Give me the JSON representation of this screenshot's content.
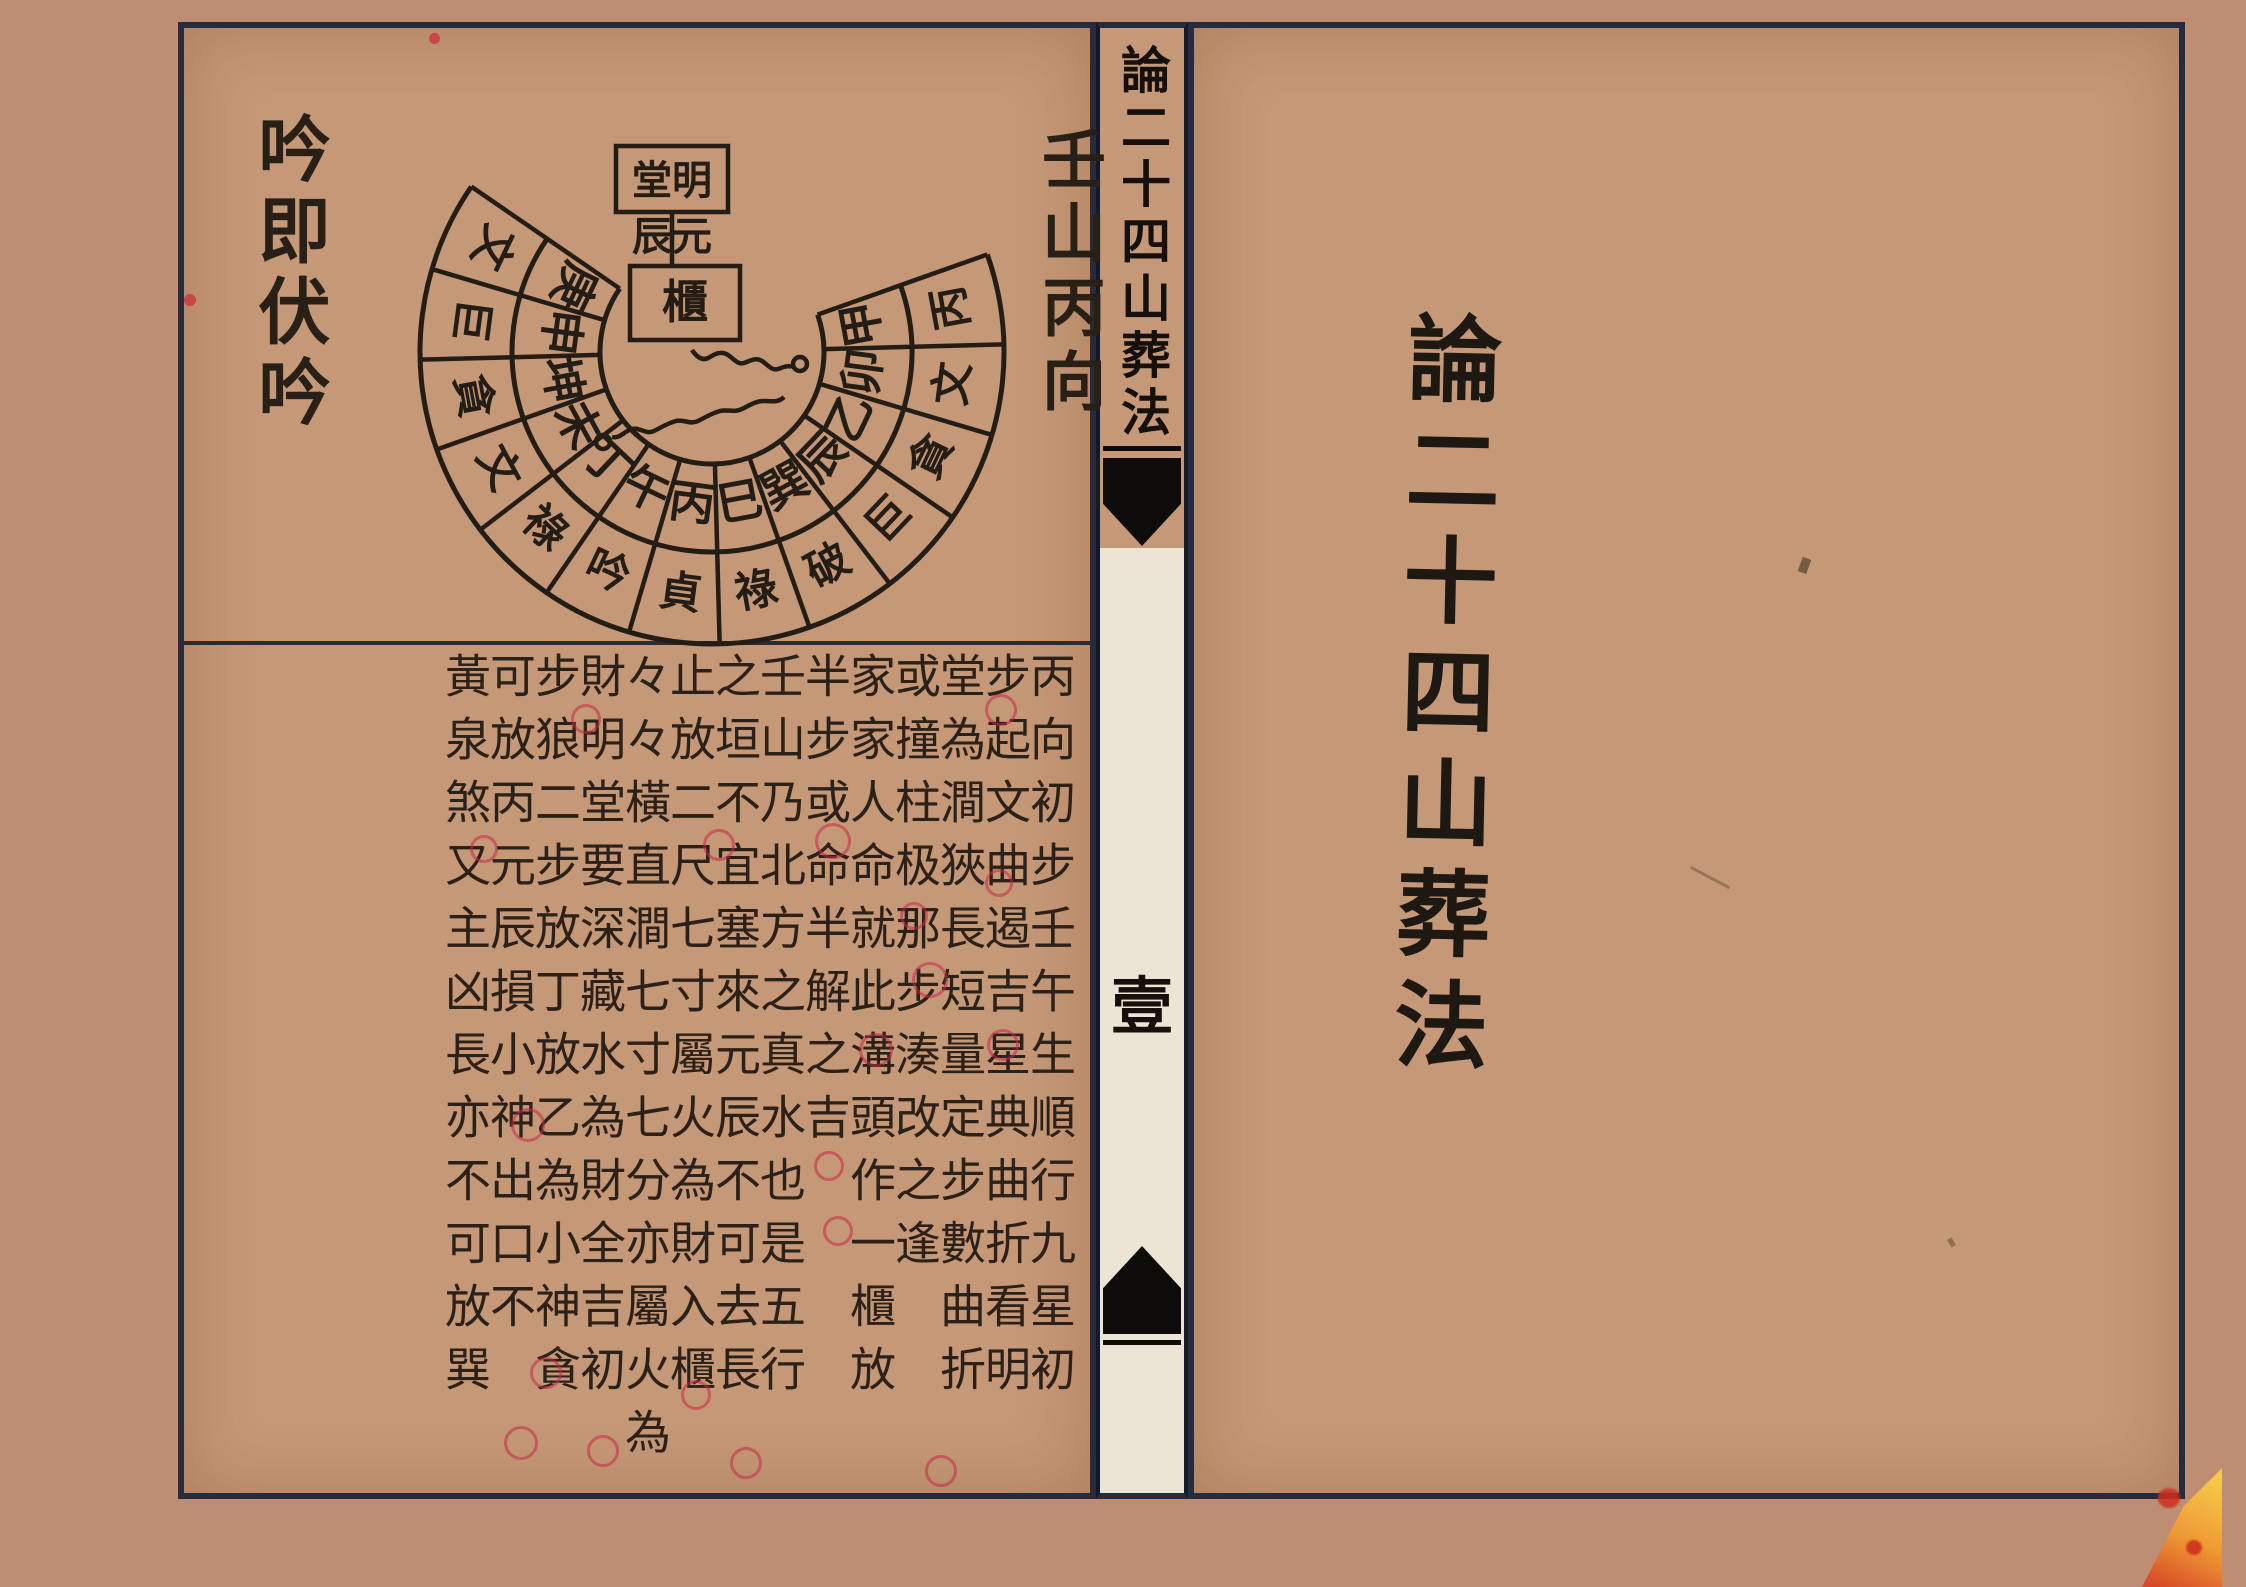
{
  "work_title": "論二十四山葬法",
  "left_page": {
    "corner_note": "吟即伏吟",
    "orientation_label": "壬山丙向",
    "diagram": {
      "center_labels": {
        "mingtang_boxed": "堂明",
        "yuanchen": "辰元",
        "cabinet_boxed": "櫃"
      },
      "cells": [
        {
          "mountain": "甲",
          "star": "丙"
        },
        {
          "mountain": "卯",
          "star": "文"
        },
        {
          "mountain": "乙",
          "star": "貪"
        },
        {
          "mountain": "辰",
          "star": "巨"
        },
        {
          "mountain": "巽",
          "star": "破"
        },
        {
          "mountain": "巳",
          "star": "祿"
        },
        {
          "mountain": "丙",
          "star": "貞"
        },
        {
          "mountain": "午",
          "star": "吟"
        },
        {
          "mountain": "丁",
          "star": "祿"
        },
        {
          "mountain": "未",
          "star": "文"
        },
        {
          "mountain": "坤",
          "star": "貪"
        },
        {
          "mountain": "申",
          "star": "巨"
        },
        {
          "mountain": "庚",
          "star": "文"
        }
      ]
    },
    "text_columns": [
      "丙向初步壬午生順行九星初",
      "步起文曲遏吉星典曲折看明",
      "堂為澗狹長短量定步數曲折",
      "或撞柱极那步湊改之逢",
      "家家人命就此溝頭作一櫃放",
      "半步或命半解之吉",
      "壬山乃北方之真水也是五行",
      "之垣不宜塞來元辰不可去長",
      "止放二尺七寸屬火為財入櫃",
      "々々橫直澗七寸七分亦屬火為",
      "財明堂要深藏水為財全吉初",
      "步狼二步放丁放乙為小神貪",
      "可放丙元辰損小神出口不",
      "黃泉煞又主凶長亦不可放巽"
    ],
    "red_marks": [
      {
        "x": 998,
        "y": 707,
        "d": 26
      },
      {
        "x": 583,
        "y": 716,
        "d": 24
      },
      {
        "x": 830,
        "y": 838,
        "d": 30
      },
      {
        "x": 716,
        "y": 842,
        "d": 26
      },
      {
        "x": 481,
        "y": 846,
        "d": 22
      },
      {
        "x": 996,
        "y": 880,
        "d": 22
      },
      {
        "x": 911,
        "y": 913,
        "d": 22
      },
      {
        "x": 927,
        "y": 977,
        "d": 30
      },
      {
        "x": 873,
        "y": 1047,
        "d": 28
      },
      {
        "x": 1000,
        "y": 1042,
        "d": 26
      },
      {
        "x": 525,
        "y": 1122,
        "d": 28
      },
      {
        "x": 826,
        "y": 1163,
        "d": 24
      },
      {
        "x": 835,
        "y": 1228,
        "d": 24
      },
      {
        "x": 543,
        "y": 1370,
        "d": 26
      },
      {
        "x": 693,
        "y": 1392,
        "d": 24
      },
      {
        "x": 518,
        "y": 1440,
        "d": 28
      },
      {
        "x": 600,
        "y": 1448,
        "d": 26
      },
      {
        "x": 743,
        "y": 1460,
        "d": 26
      },
      {
        "x": 938,
        "y": 1468,
        "d": 26
      },
      {
        "x": 190,
        "y": 300,
        "d": 12,
        "filled": true
      },
      {
        "x": 434,
        "y": 38,
        "d": 11,
        "filled": true
      }
    ]
  },
  "spine": {
    "title": "論二十四山葬法",
    "page_number": "壹"
  },
  "right_page": {
    "title": "論二十四山葬法"
  }
}
